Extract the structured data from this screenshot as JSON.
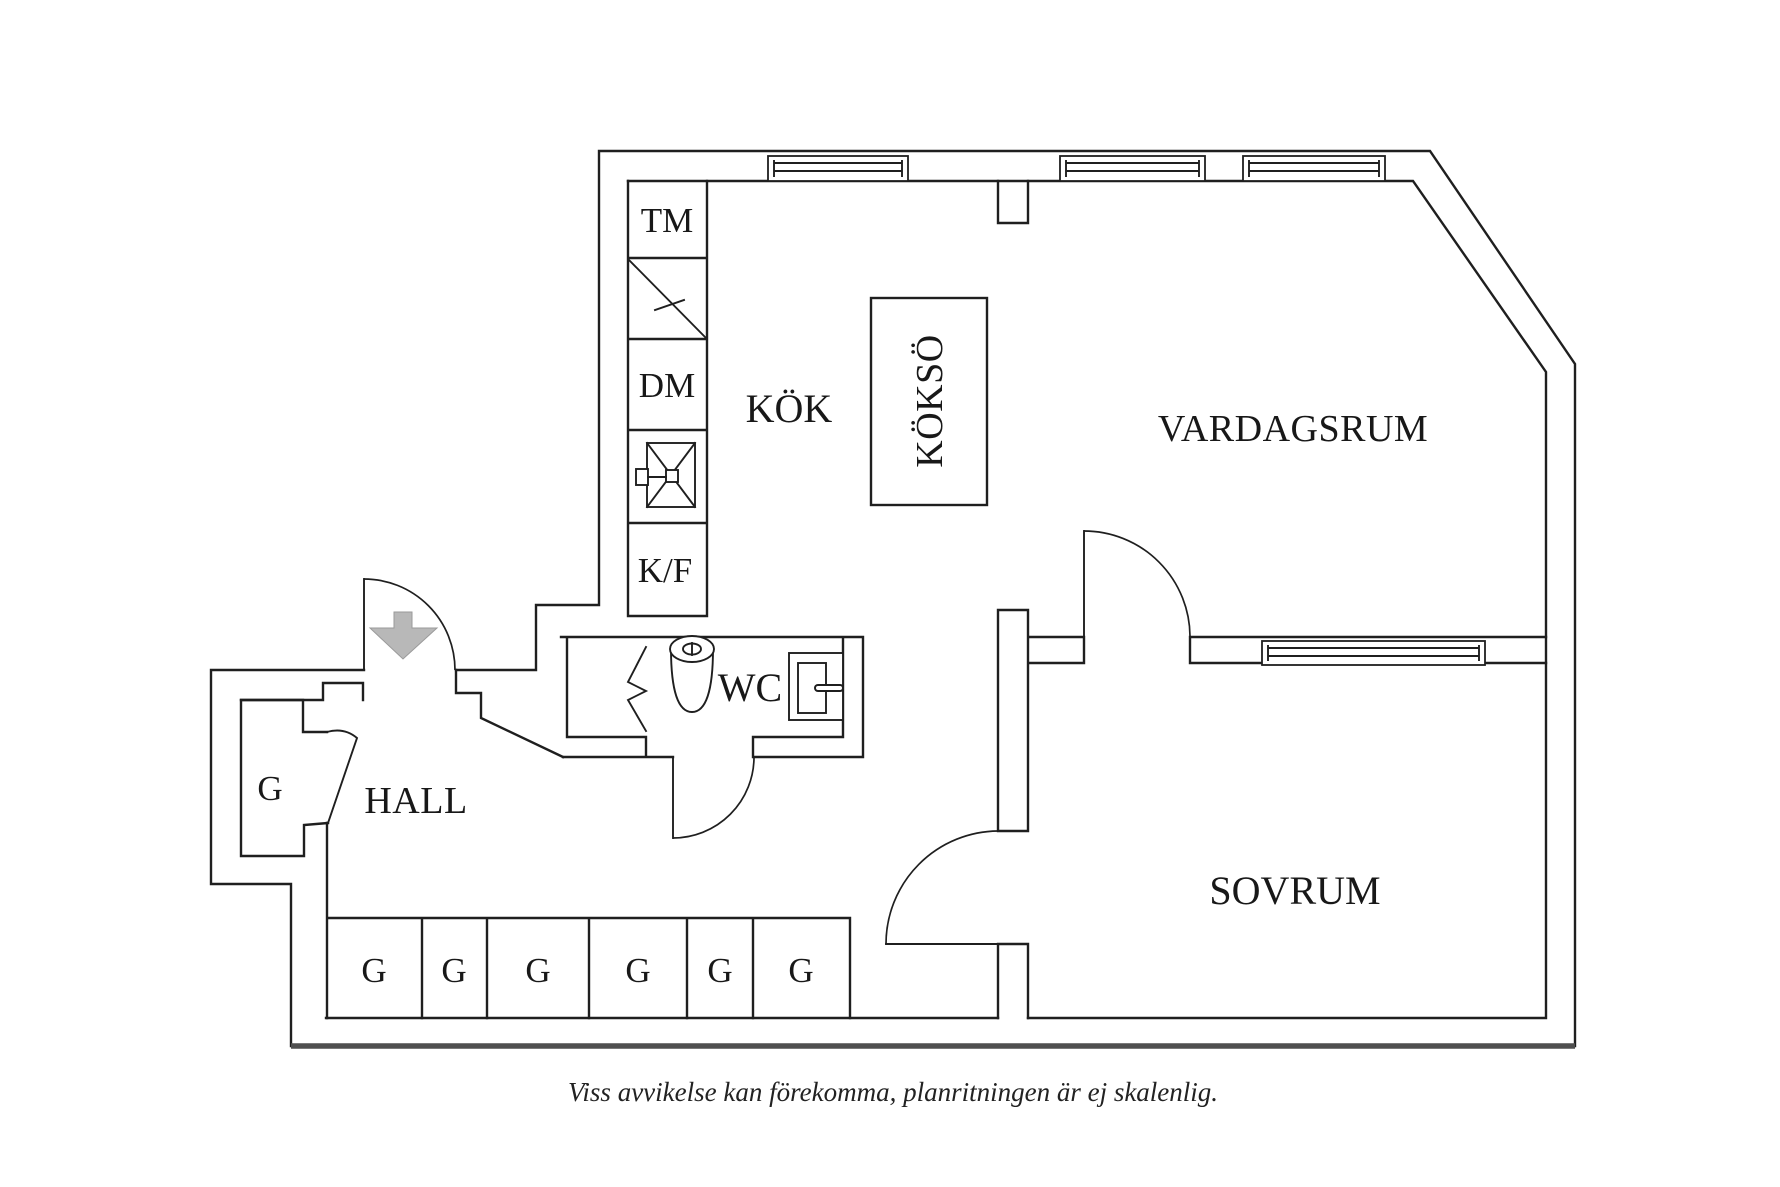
{
  "labels": {
    "kitchen": "KÖK",
    "island": "KÖKSÖ",
    "living_room": "VARDAGSRUM",
    "bedroom": "SOVRUM",
    "hall": "HALL",
    "wc": "WC",
    "washing_machine": "TM",
    "dishwasher": "DM",
    "fridge_freezer": "K/F"
  },
  "closets": [
    "G",
    "G",
    "G",
    "G",
    "G",
    "G",
    "G"
  ],
  "caption": "Viss avvikelse kan förekomma, planritningen är ej skalenlig.",
  "colors": {
    "line": "#1f1f1f",
    "arrow": "#b8b8b8",
    "arrow_edge": "#9a9a9a",
    "base_line": "#4f4f4f",
    "background": "#ffffff"
  }
}
